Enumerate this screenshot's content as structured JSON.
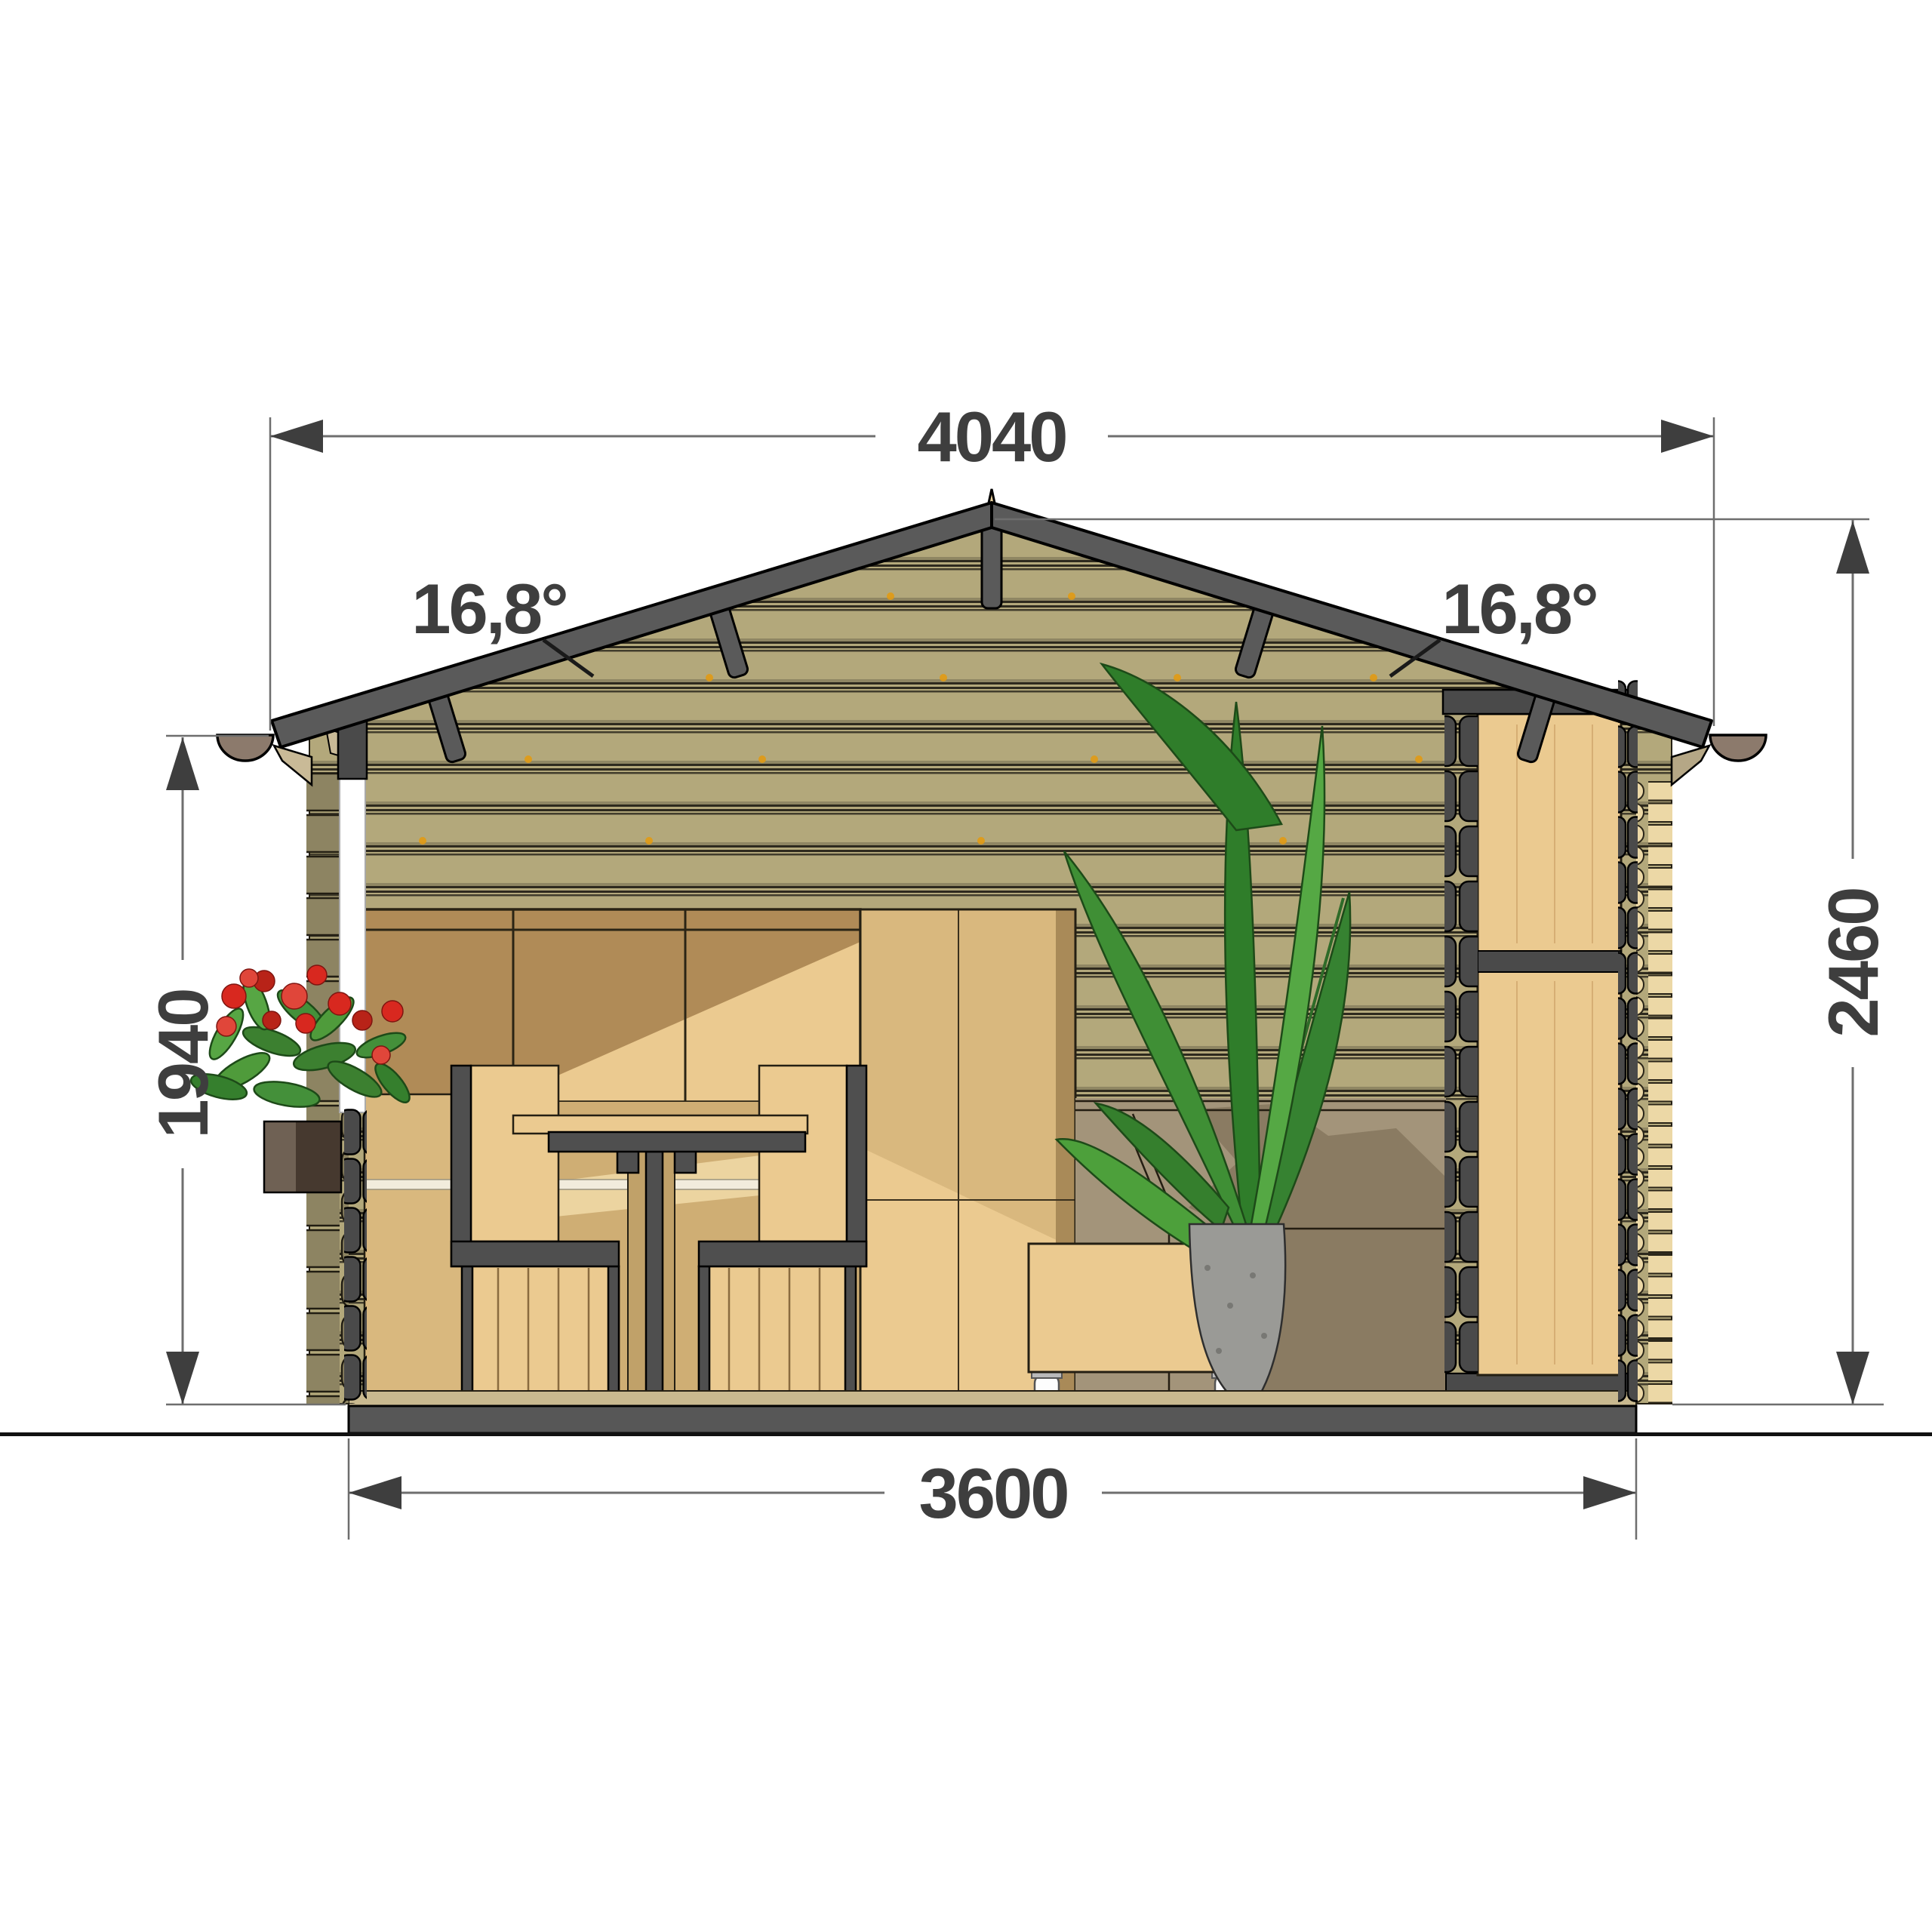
{
  "drawing": {
    "type": "architectural-cross-section",
    "subject": "log cabin garden house section with interior furniture",
    "dimensions": {
      "roof_width": "4040",
      "base_width": "3600",
      "wall_height": "1940",
      "total_height": "2460",
      "roof_angle_left": "16,8°",
      "roof_angle_right": "16,8°"
    }
  },
  "colors": {
    "dim_text": "#3e3e3e",
    "dim_line": "#6e6e6e",
    "leader": "#1a1a1a",
    "roof_frame": "#5a5a5a",
    "siding": "#b3a87b",
    "siding_joint": "#2e2a1e",
    "wood_light": "#ebca90",
    "wood_mid": "#d9b87e",
    "wood_shadow": "#b08b57",
    "cut_log": "#4a4a4a",
    "exterior_log": "#ecd8a6",
    "left_log": "#8d8462",
    "gutter": "#8c7a6c",
    "soffit": "#c9ba97",
    "slab": "#575757",
    "sofa": "#a3947a",
    "sofa_shadow": "#8a7b62",
    "leaf": "#3f8f35",
    "flower": "#d8281f",
    "vase": "#9a9a96",
    "frame": "#4f4f4f"
  }
}
